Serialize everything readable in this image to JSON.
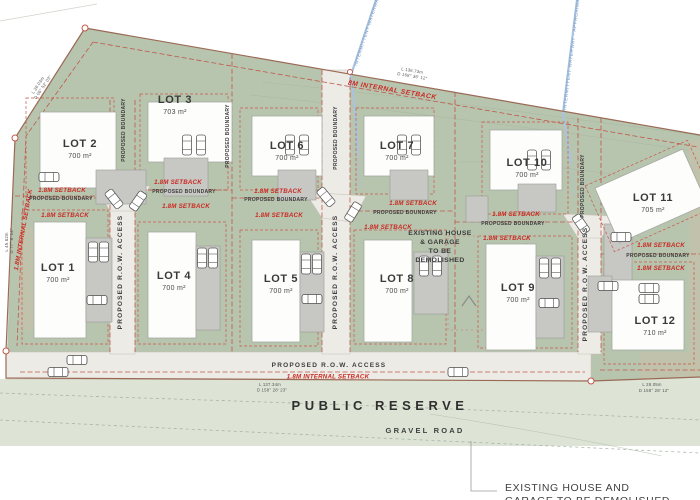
{
  "lots": [
    {
      "name": "LOT 1",
      "area": "700 m²"
    },
    {
      "name": "LOT 2",
      "area": "700 m²"
    },
    {
      "name": "LOT 3",
      "area": "703 m²"
    },
    {
      "name": "LOT 4",
      "area": "700 m²"
    },
    {
      "name": "LOT 5",
      "area": "700 m²"
    },
    {
      "name": "LOT 6",
      "area": "700 m²"
    },
    {
      "name": "LOT 7",
      "area": "700 m²"
    },
    {
      "name": "LOT 8",
      "area": "700 m²"
    },
    {
      "name": "LOT 9",
      "area": "700 m²"
    },
    {
      "name": "LOT 10",
      "area": "700 m²"
    },
    {
      "name": "LOT 11",
      "area": "705 m²"
    },
    {
      "name": "LOT 12",
      "area": "710 m²"
    }
  ],
  "annotations": {
    "setback": "1.8M SETBACK",
    "internal_setback": "1.8M INTERNAL SETBACK",
    "internal_setback_8m": "8M INTERNAL SETBACK",
    "proposed_boundary": "PROPOSED BOUNDARY",
    "row_access": "PROPOSED R.O.W. ACCESS",
    "public_reserve": "PUBLIC RESERVE",
    "gravel_road": "GRAVEL ROAD",
    "waterway": "INTERMITTENT WATERWAY - APPROXIMATE POSITION",
    "demolish_lines": [
      "EXISTING HOUSE",
      "& GARAGE",
      "TO BE",
      "DEMOLISHED"
    ],
    "demolish_bottom_lines": [
      "EXISTING HOUSE AND",
      "GARAGE TO BE DEMOLISHED"
    ]
  },
  "dimensions": {
    "top": {
      "length": "L 136.73m",
      "bearing": "D 168° 36' 12\""
    },
    "top_left": {
      "length": "L 28.03m",
      "bearing": "D 06° 52' 03\""
    },
    "west": {
      "length": "L 45.62m",
      "bearing": "D 77° 8' 14\""
    },
    "south": {
      "length": "L 137.34m",
      "bearing": "D 158° 28' 23\""
    },
    "south_east": {
      "length": "L 28.05m",
      "bearing": "D 158° 28' 12\""
    }
  },
  "colors": {
    "site_green": "#b7c4ae",
    "reserve_green": "#dde4d6",
    "road_gray": "#edebe6",
    "boundary_red": "#c0584a",
    "setback_text_red": "#cc2a23",
    "waterway_blue": "#aac4df",
    "waterway_text_blue": "#7b9cc6"
  }
}
